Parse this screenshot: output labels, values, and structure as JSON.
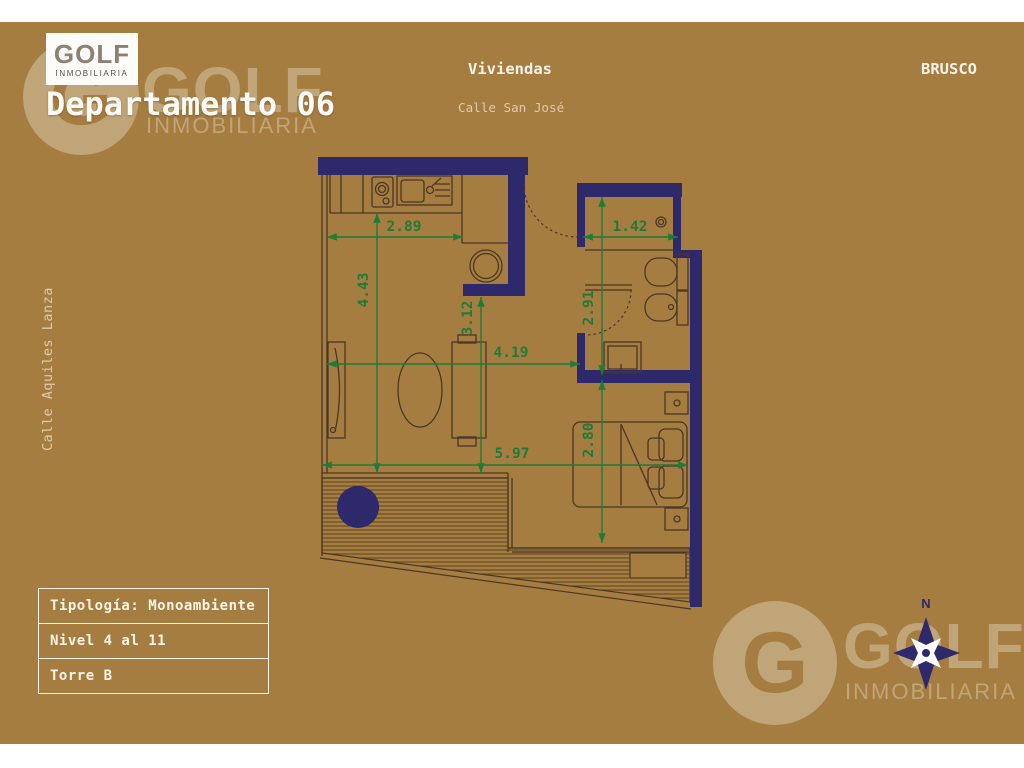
{
  "brand": {
    "logo_text": "GOLF",
    "logo_sub": "INMOBILIARIA",
    "watermark_letter": "G",
    "watermark_text": "GOLF",
    "watermark_sub": "INMOBILIARIA"
  },
  "header": {
    "title": "Departamento 06",
    "project_type": "Viviendas",
    "street_top": "Calle San José",
    "developer": "BRUSCO"
  },
  "street_left": "Calle Aquiles Lanza",
  "plan": {
    "dims": {
      "kitchen_width": "2.89",
      "living_height": "4.43",
      "pass_height": "3.12",
      "closet_width": "1.42",
      "bath_height": "2.91",
      "living_width": "4.19",
      "total_width": "5.97",
      "bedroom_width": "2.80"
    }
  },
  "info_table": {
    "rows": [
      {
        "label": "Tipología: Monoambiente"
      },
      {
        "label": "Nivel 4 al 11"
      },
      {
        "label": "Torre B"
      }
    ]
  },
  "compass": {
    "north_label": "N"
  },
  "colors": {
    "background": "#a67d41",
    "wall_navy": "#2d296b",
    "dimension_green": "#1d7c39",
    "drawing_line": "#4a3725",
    "watermark_beige": "#c5ae83",
    "logo_gray": "#8e8174",
    "text_white": "#faf5e8"
  }
}
